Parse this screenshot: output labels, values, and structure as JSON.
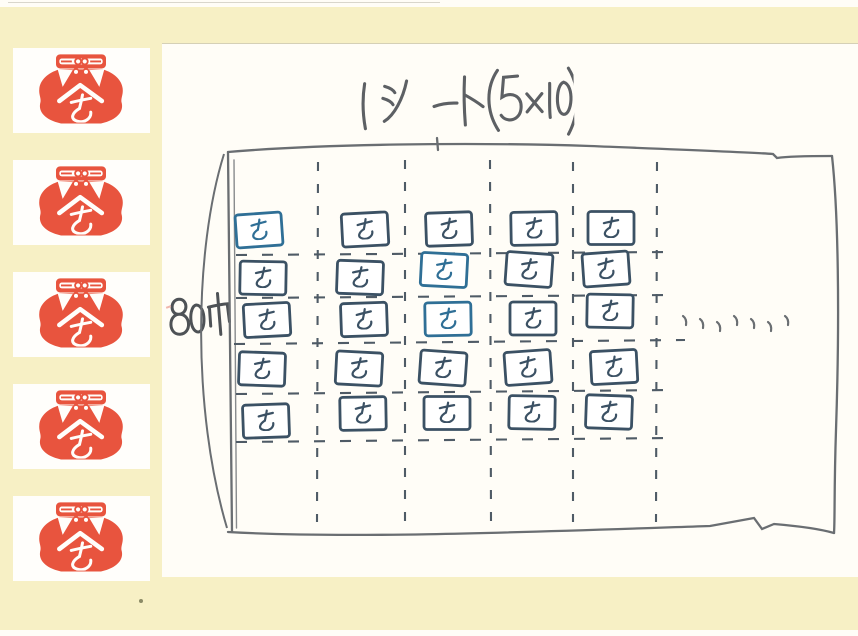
{
  "page": {
    "background_paper": "#fffdf7",
    "band_color": "#f7f0c5",
    "stamp_red": "#e8543e",
    "ink_slate": "#3b5164",
    "ink_blue": "#2f6f96",
    "pencil_gray": "#6a6e72",
    "dash_gray": "#4f5b66",
    "handwriting_gray": "#5d6064"
  },
  "sidebar": {
    "stamps": [
      "と",
      "と",
      "と",
      "と",
      "と"
    ],
    "stamp_motif": "red pot with lid, rope knot and white へ over と"
  },
  "drawing": {
    "title": {
      "full": "1シート(5×10)"
    },
    "width_label": {
      "full": "80巾"
    },
    "grid": {
      "rows": 5,
      "cols_visible": 5,
      "cols_total": 10,
      "cell_char": "と",
      "blue_cells": [
        [
          0,
          0
        ],
        [
          1,
          2
        ],
        [
          2,
          2
        ]
      ],
      "continuation_marks": 7
    }
  }
}
